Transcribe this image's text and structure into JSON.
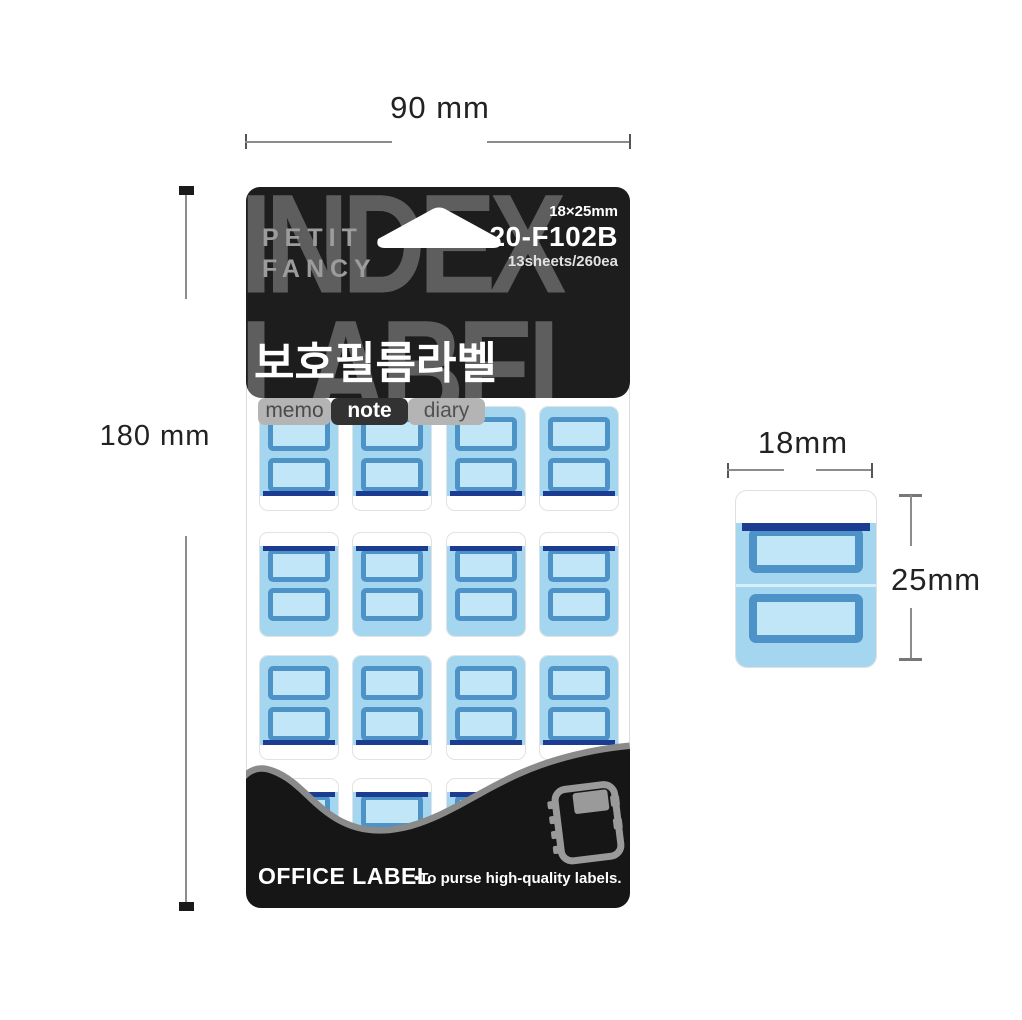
{
  "dims": {
    "width_label": "90 mm",
    "height_label": "180 mm",
    "tab_width": "18mm",
    "tab_height": "25mm"
  },
  "package": {
    "watermark_top": "INDEX",
    "watermark_bottom": "LABEL",
    "brand_line1": "PETIT",
    "brand_line2": "FANCY",
    "size": "18×25mm",
    "model": "20-F102B",
    "count": "13sheets/260ea",
    "title": "보호필름라벨",
    "tabs": [
      {
        "label": "memo",
        "active": false
      },
      {
        "label": "note",
        "active": true
      },
      {
        "label": "diary",
        "active": false
      }
    ],
    "footer": {
      "brand": "OFFICE LABEL",
      "tagline": "•To purse high-quality labels."
    }
  },
  "sheet": {
    "columns": 4,
    "rows": 4,
    "col_x": [
      13,
      106,
      200,
      293
    ],
    "row_y": [
      219,
      345,
      468,
      591
    ],
    "row_variants": [
      "blue-top",
      "white-top",
      "blue-top",
      "white-top"
    ]
  },
  "colors": {
    "package_black": "#1d1d1d",
    "watermark_gray": "#5e5e5e",
    "film_blue": "#a5d6ef",
    "field_fill": "#c0e6f8",
    "field_border": "#4e93c8",
    "navy_edge": "#1c3c91",
    "wave_gray": "#8a8a8a",
    "tab_gray": "#b4b4b4"
  }
}
